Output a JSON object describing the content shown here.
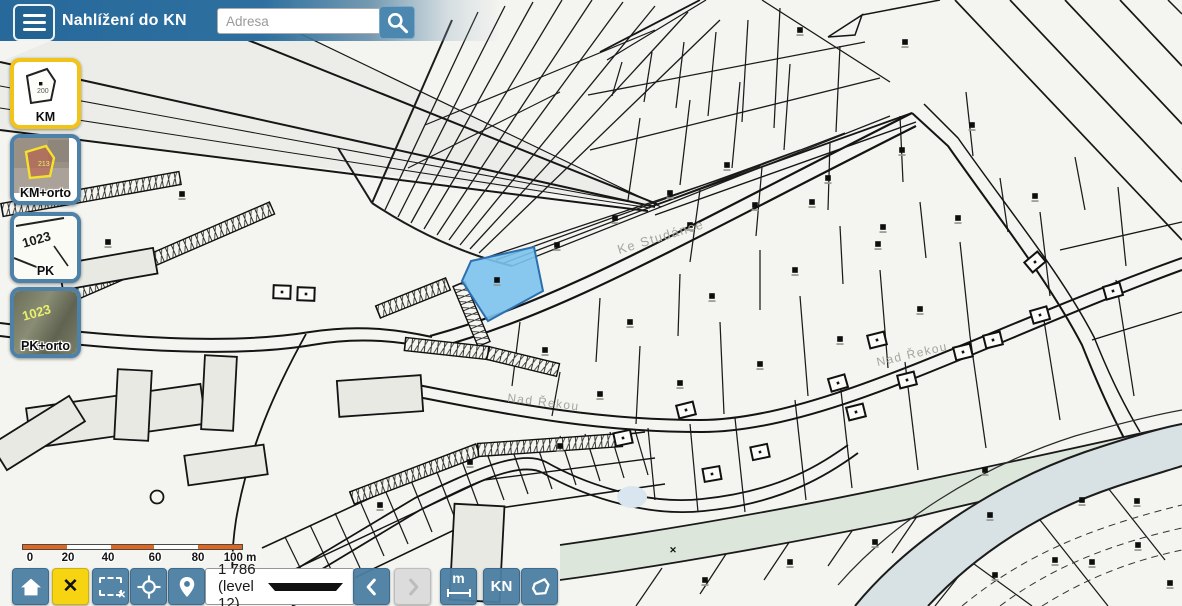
{
  "app": {
    "title": "Nahlížení do KN"
  },
  "header": {
    "search_placeholder": "Adresa",
    "search_value": ""
  },
  "layers": {
    "items": [
      {
        "id": "km",
        "label": "KM",
        "thumb_text": "200",
        "selected": true
      },
      {
        "id": "km-orto",
        "label": "KM+orto",
        "thumb_text": "213",
        "selected": false
      },
      {
        "id": "pk",
        "label": "PK",
        "thumb_text": "1023",
        "selected": false
      },
      {
        "id": "pk-orto",
        "label": "PK+orto",
        "thumb_text": "1023",
        "selected": false
      }
    ]
  },
  "toolbar": {
    "zoom_scale": "1 786 (level 12)",
    "kn_label": "KN",
    "measure_label": "m",
    "buttons": [
      "home",
      "cancel",
      "clear-selection",
      "locate",
      "add-point",
      "back",
      "forward",
      "measure",
      "kn",
      "polygon"
    ]
  },
  "scale_bar": {
    "segments": 5,
    "labels": [
      {
        "text": "0",
        "x": 30
      },
      {
        "text": "20",
        "x": 68
      },
      {
        "text": "40",
        "x": 108
      },
      {
        "text": "60",
        "x": 155
      },
      {
        "text": "80",
        "x": 198
      },
      {
        "text": "100 m",
        "x": 240
      }
    ]
  },
  "colors": {
    "header_blue": "#27699a",
    "button_blue": "#4b7da1",
    "selected_layer_border": "#f0c419",
    "cancel_yellow": "#f6d411",
    "scale_orange": "#e0671f",
    "parcel_highlight_fill": "#7cc3ee",
    "parcel_highlight_stroke": "#2b6fae",
    "river_fill": "#d8e1e4",
    "stream_fill": "#dde6da",
    "map_line": "#1a1a1a",
    "street_label_gray": "#a6a69e"
  },
  "map": {
    "street_labels": [
      {
        "text": "Ke Studánce",
        "x": 662,
        "y": 241,
        "rot": -17,
        "size": 13
      },
      {
        "text": "Nad Řekou",
        "x": 543,
        "y": 406,
        "rot": 7,
        "size": 12
      },
      {
        "text": "Nad Řekou",
        "x": 913,
        "y": 358,
        "rot": -13,
        "size": 12
      }
    ],
    "selected_parcel": {
      "points": "462,281 471,261 534,247 543,291 488,321"
    },
    "markers": [
      [
        497,
        280
      ],
      [
        557,
        245
      ],
      [
        615,
        218
      ],
      [
        690,
        225
      ],
      [
        755,
        205
      ],
      [
        828,
        178
      ],
      [
        902,
        150
      ],
      [
        972,
        125
      ],
      [
        800,
        30
      ],
      [
        905,
        42
      ],
      [
        670,
        193
      ],
      [
        727,
        165
      ],
      [
        812,
        202
      ],
      [
        883,
        227
      ],
      [
        545,
        350
      ],
      [
        630,
        322
      ],
      [
        712,
        296
      ],
      [
        795,
        270
      ],
      [
        878,
        244
      ],
      [
        958,
        218
      ],
      [
        1035,
        196
      ],
      [
        600,
        394
      ],
      [
        680,
        383
      ],
      [
        760,
        364
      ],
      [
        840,
        339
      ],
      [
        920,
        309
      ],
      [
        705,
        580
      ],
      [
        790,
        562
      ],
      [
        875,
        542
      ],
      [
        985,
        470
      ],
      [
        990,
        515
      ],
      [
        1082,
        500
      ],
      [
        1137,
        501
      ],
      [
        995,
        575
      ],
      [
        1055,
        560
      ],
      [
        1092,
        562
      ],
      [
        1138,
        545
      ],
      [
        1170,
        583
      ],
      [
        380,
        505
      ],
      [
        470,
        462
      ],
      [
        560,
        446
      ],
      [
        182,
        194
      ],
      [
        108,
        242
      ]
    ],
    "houses": [
      [
        623,
        438,
        -12
      ],
      [
        686,
        410,
        -14
      ],
      [
        712,
        474,
        -10
      ],
      [
        760,
        452,
        -12
      ],
      [
        838,
        383,
        -16
      ],
      [
        856,
        412,
        -14
      ],
      [
        877,
        340,
        -14
      ],
      [
        907,
        380,
        -14
      ],
      [
        963,
        352,
        -14
      ],
      [
        993,
        340,
        -14
      ],
      [
        1040,
        315,
        -16
      ],
      [
        1113,
        291,
        -16
      ],
      [
        1035,
        262,
        -40
      ],
      [
        282,
        292,
        2
      ],
      [
        306,
        294,
        2
      ]
    ],
    "buildings": [
      [
        28,
        396,
        176,
        40,
        -8
      ],
      [
        116,
        370,
        34,
        70,
        3
      ],
      [
        203,
        356,
        32,
        74,
        3
      ],
      [
        338,
        378,
        84,
        36,
        -4
      ],
      [
        452,
        505,
        50,
        96,
        3
      ],
      [
        60,
        256,
        96,
        26,
        -10
      ],
      [
        -8,
        418,
        92,
        30,
        -32
      ],
      [
        186,
        450,
        80,
        30,
        -8
      ]
    ],
    "garages": [
      [
        2,
        210,
        180,
        178
      ],
      [
        60,
        300,
        272,
        208
      ],
      [
        378,
        312,
        448,
        284
      ],
      [
        459,
        284,
        484,
        344
      ],
      [
        405,
        344,
        488,
        353
      ],
      [
        488,
        353,
        558,
        370
      ],
      [
        352,
        498,
        478,
        450
      ],
      [
        478,
        450,
        622,
        440
      ]
    ],
    "mesh": [
      [
        700,
        190,
        690,
        262
      ],
      [
        762,
        167,
        756,
        236
      ],
      [
        830,
        142,
        828,
        210
      ],
      [
        900,
        116,
        903,
        182
      ],
      [
        966,
        92,
        973,
        156
      ],
      [
        622,
        62,
        612,
        96
      ],
      [
        652,
        52,
        644,
        102
      ],
      [
        684,
        42,
        676,
        108
      ],
      [
        716,
        32,
        708,
        116
      ],
      [
        748,
        20,
        742,
        122
      ],
      [
        780,
        8,
        774,
        128
      ],
      [
        640,
        118,
        628,
        200
      ],
      [
        690,
        100,
        680,
        185
      ],
      [
        740,
        82,
        732,
        168
      ],
      [
        790,
        64,
        784,
        150
      ],
      [
        840,
        46,
        836,
        132
      ],
      [
        588,
        95,
        865,
        42
      ],
      [
        590,
        150,
        880,
        78
      ],
      [
        520,
        322,
        512,
        386
      ],
      [
        600,
        298,
        596,
        362
      ],
      [
        680,
        274,
        678,
        336
      ],
      [
        760,
        250,
        760,
        310
      ],
      [
        840,
        226,
        843,
        284
      ],
      [
        920,
        202,
        926,
        258
      ],
      [
        1000,
        178,
        1008,
        232
      ],
      [
        1075,
        157,
        1085,
        210
      ],
      [
        560,
        372,
        552,
        416
      ],
      [
        640,
        346,
        636,
        424
      ],
      [
        720,
        322,
        724,
        414
      ],
      [
        800,
        296,
        808,
        396
      ],
      [
        880,
        270,
        888,
        368
      ],
      [
        960,
        242,
        970,
        336
      ],
      [
        1040,
        212,
        1050,
        296
      ],
      [
        1118,
        187,
        1126,
        266
      ],
      [
        648,
        428,
        655,
        500
      ],
      [
        690,
        424,
        698,
        512
      ],
      [
        735,
        418,
        745,
        512
      ],
      [
        795,
        400,
        806,
        500
      ],
      [
        840,
        382,
        852,
        488
      ],
      [
        905,
        362,
        918,
        470
      ],
      [
        970,
        336,
        986,
        448
      ],
      [
        1042,
        308,
        1060,
        420
      ],
      [
        1116,
        280,
        1134,
        396
      ],
      [
        636,
        606,
        662,
        568
      ],
      [
        700,
        594,
        726,
        554
      ],
      [
        764,
        580,
        790,
        541
      ],
      [
        828,
        566,
        854,
        528
      ],
      [
        892,
        553,
        918,
        515
      ],
      [
        935,
        606,
        1002,
        522
      ],
      [
        963,
        556,
        1032,
        606
      ],
      [
        1040,
        520,
        1108,
        606
      ],
      [
        1108,
        488,
        1165,
        560
      ],
      [
        285,
        537,
        312,
        592
      ],
      [
        310,
        525,
        336,
        580
      ],
      [
        335,
        513,
        360,
        568
      ],
      [
        360,
        501,
        384,
        556
      ],
      [
        385,
        490,
        408,
        544
      ],
      [
        410,
        478,
        432,
        532
      ],
      [
        435,
        467,
        456,
        521
      ],
      [
        460,
        456,
        480,
        510
      ],
      [
        485,
        448,
        504,
        500
      ],
      [
        510,
        443,
        528,
        494
      ],
      [
        535,
        439,
        552,
        489
      ],
      [
        560,
        436,
        576,
        485
      ],
      [
        585,
        434,
        600,
        481
      ],
      [
        610,
        432,
        624,
        478
      ],
      [
        635,
        430,
        648,
        475
      ]
    ],
    "stream_marker": {
      "x": 673,
      "y": 553,
      "glyph": "✕"
    }
  }
}
